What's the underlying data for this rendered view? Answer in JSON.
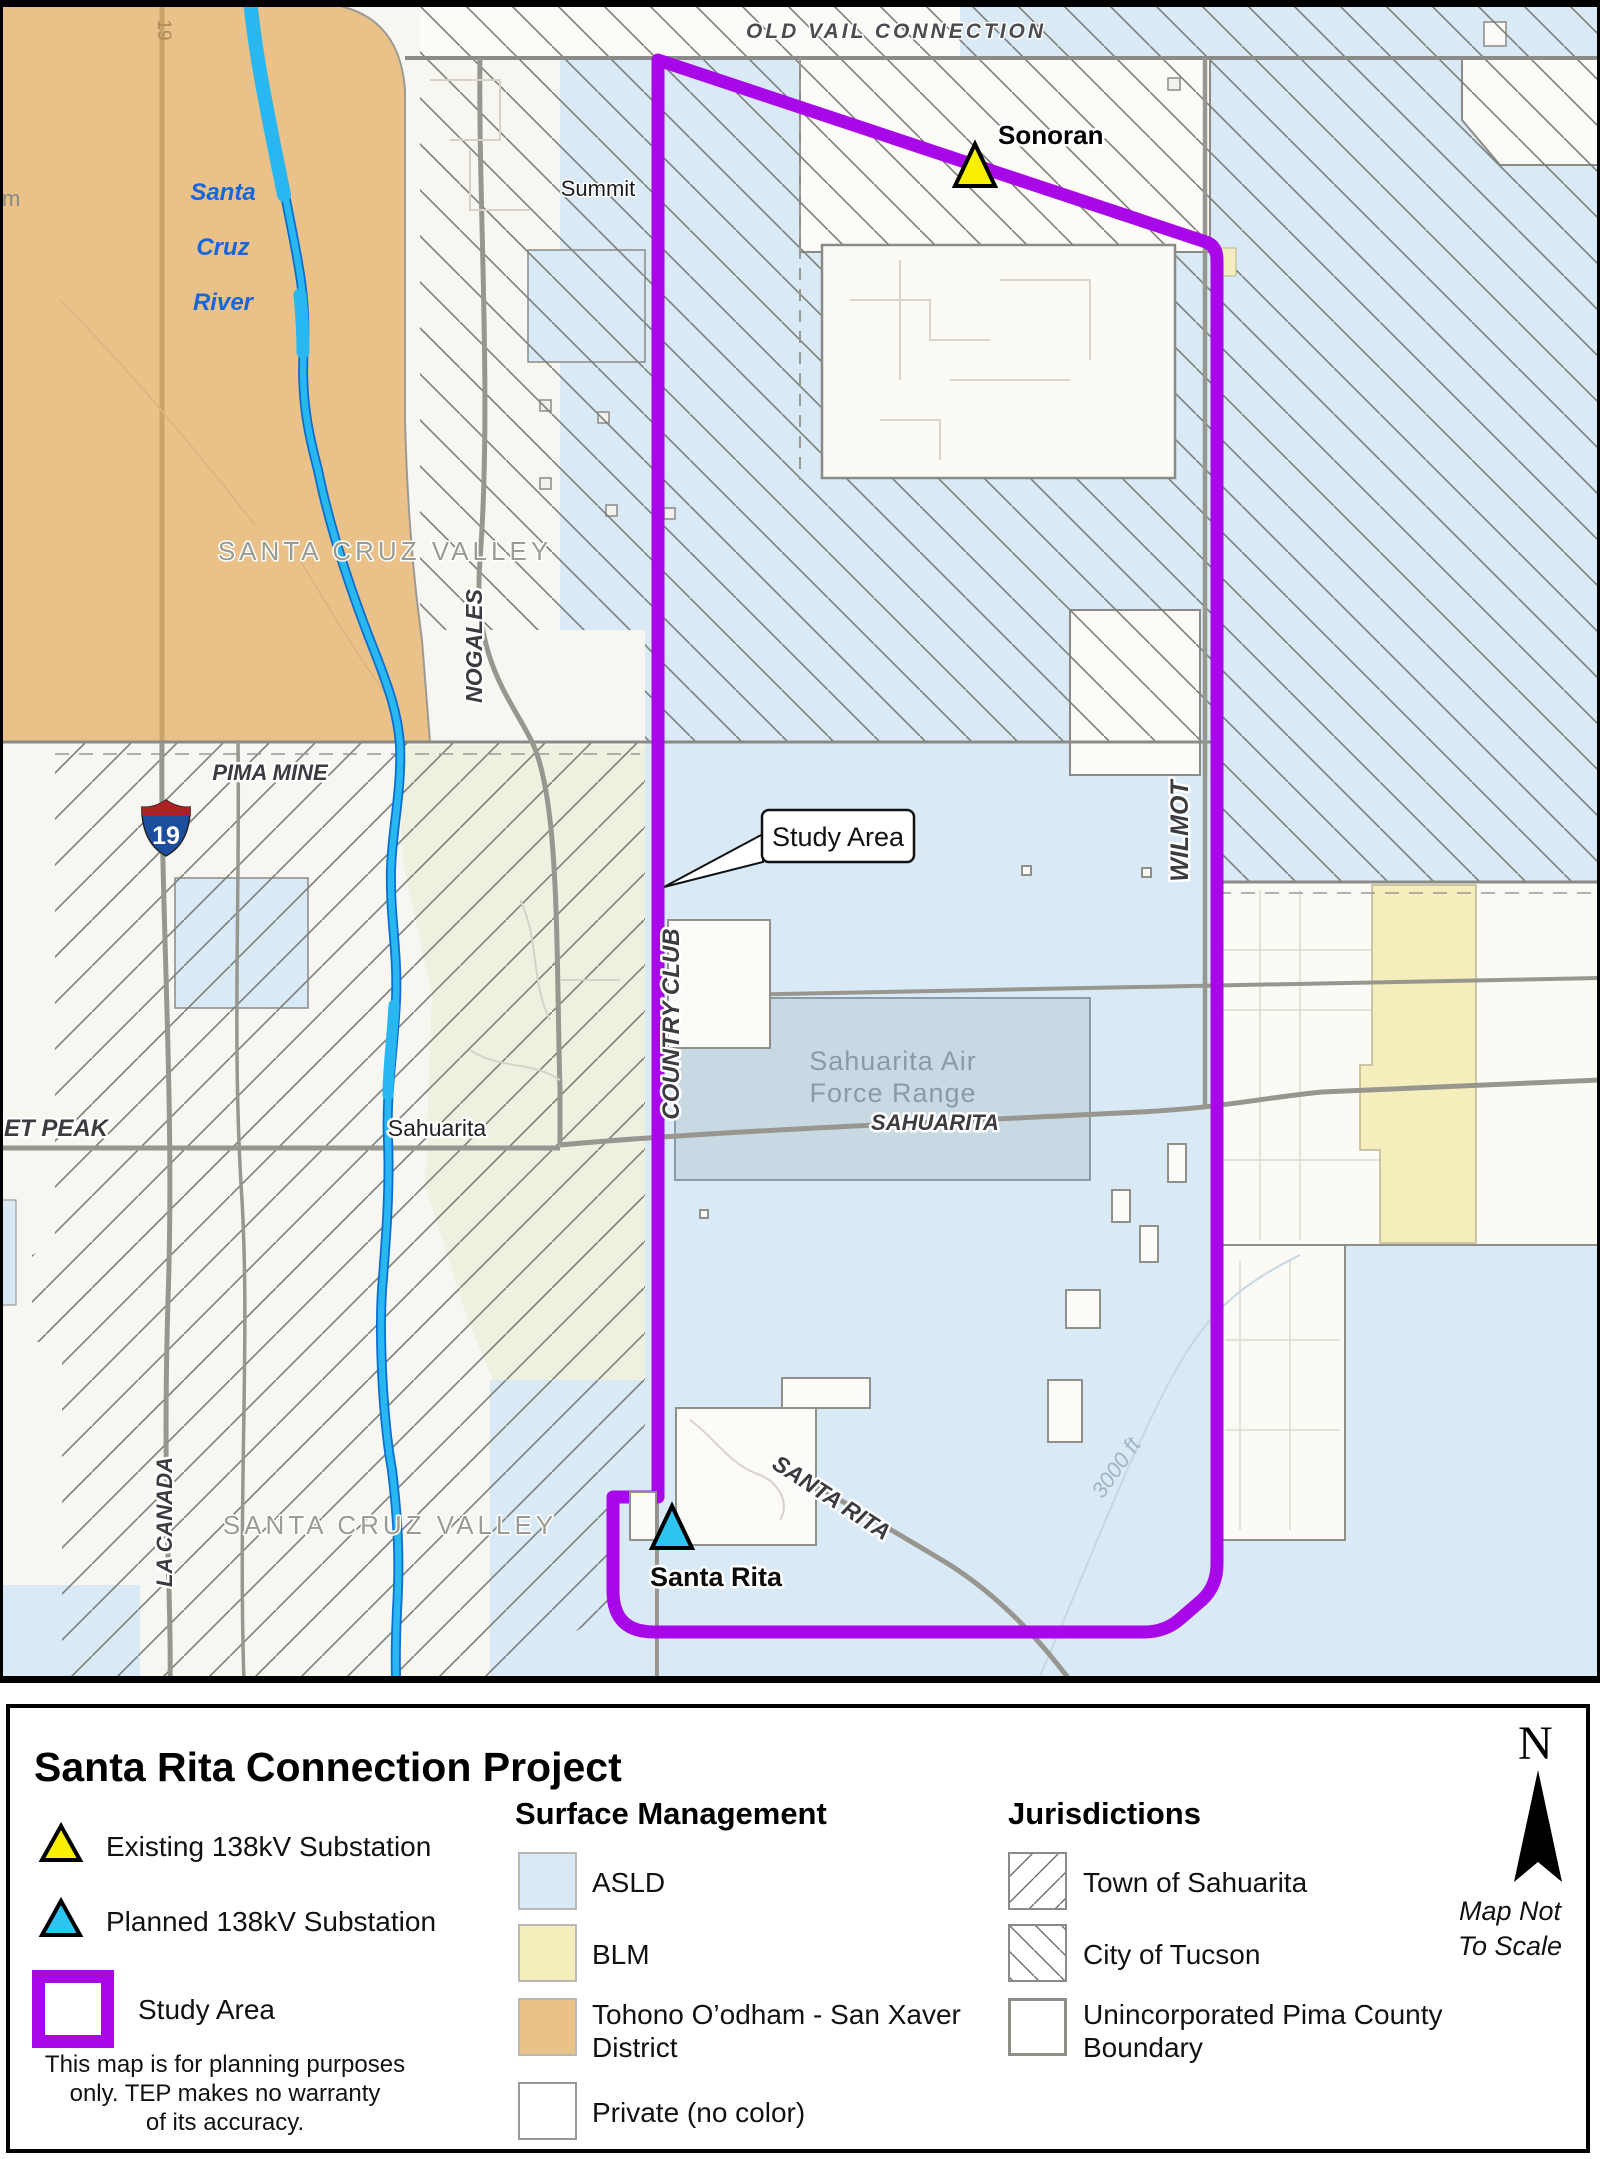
{
  "map": {
    "labels": {
      "old_vail": "OLD VAIL CONNECTION",
      "summit": "Summit",
      "sonoran": "Sonoran",
      "river_line1": "Santa",
      "river_line2": "Cruz",
      "river_line3": "River",
      "valley_upper": "SANTA CRUZ VALLEY",
      "valley_lower": "SANTA CRUZ VALLEY",
      "nogales": "NOGALES",
      "pima_mine": "PIMA MINE",
      "interstate_number": "19",
      "interstate_road_tag": "19",
      "edge_fragment": "m",
      "helmet_peak": "ET PEAK",
      "sahuarita_town": "Sahuarita",
      "la_canada": "LA CANADA",
      "country_club": "COUNTRY CLUB",
      "wilmot": "WILMOT",
      "study_area_callout": "Study Area",
      "air_range_line1": "Sahuarita Air",
      "air_range_line2": "Force Range",
      "sahuarita_road": "SAHUARITA",
      "santa_rita_road": "SANTA RITA",
      "santa_rita_sub": "Santa Rita",
      "elevation": "3000 ft"
    }
  },
  "legend": {
    "title": "Santa Rita Connection Project",
    "items": {
      "existing": "Existing 138kV Substation",
      "planned": "Planned 138kV Substation",
      "study_area": "Study Area"
    },
    "disclaimer": [
      "This map is for planning purposes",
      "only. TEP makes no warranty",
      "of its accuracy."
    ],
    "surface_management": {
      "heading": "Surface Management",
      "asld": "ASLD",
      "blm": "BLM",
      "tohono": "Tohono O’odham - San Xaver District",
      "private": "Private (no color)"
    },
    "jurisdictions": {
      "heading": "Jurisdictions",
      "sahuarita": "Town of Sahuarita",
      "tucson": "City of Tucson",
      "unincorporated": "Unincorporated Pima County Boundary"
    },
    "north": {
      "letter": "N",
      "note1": "Map Not",
      "note2": "To Scale"
    }
  },
  "colors": {
    "study_area_purple": "#a808e8",
    "asld_blue": "#d9e9f6",
    "blm_yellow": "#f4eebc",
    "tohono_orange": "#eac189",
    "existing_sub_yellow": "#f8f000",
    "planned_sub_cyan": "#2ec4f0",
    "river_blue": "#29b7f1"
  }
}
